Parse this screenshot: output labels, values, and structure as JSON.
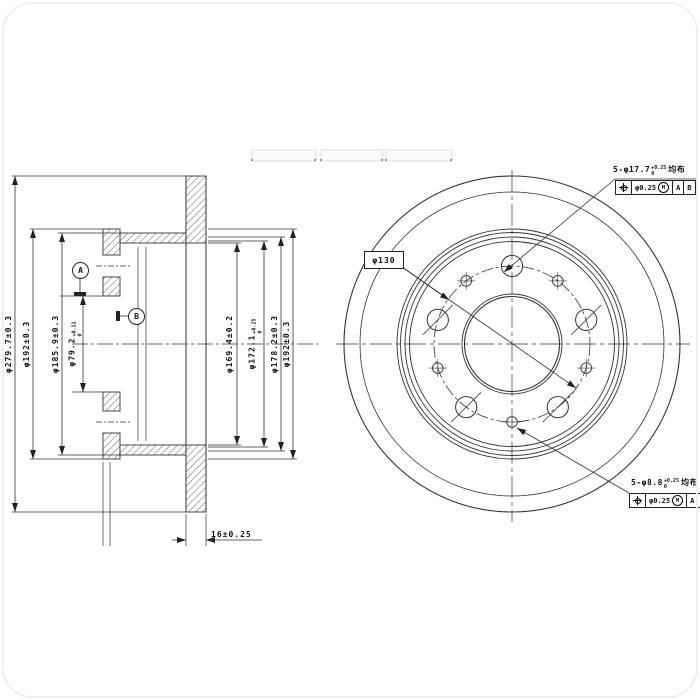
{
  "header_boxes": [
    "",
    "",
    ""
  ],
  "section_view": {
    "left_dimensions": [
      {
        "name": "disc-outer-diameter",
        "label": "φ279.7±0.3"
      },
      {
        "name": "flange-outer-diameter",
        "label": "φ192±0.3"
      },
      {
        "name": "hat-outer-diameter",
        "label": "φ185.9±0.3"
      },
      {
        "name": "center-bore",
        "label": "φ79.2",
        "tol_sup": "+0.11",
        "tol_sub": "0"
      }
    ],
    "right_dimensions": [
      {
        "name": "hat-inner-diameter",
        "label": "φ169.4±0.2"
      },
      {
        "name": "pilot-diameter",
        "label": "φ172.1",
        "tol_sup": "+0.25",
        "tol_sub": "0"
      },
      {
        "name": "recess-diameter",
        "label": "φ178.2±0.3"
      },
      {
        "name": "flange-outer-diameter",
        "label": "φ192±0.3"
      }
    ],
    "thickness": {
      "label": "16±0.25"
    },
    "datums": {
      "a": "A",
      "b": "B"
    }
  },
  "front_view": {
    "bolt_circle_label": "φ130",
    "callouts": {
      "top": {
        "dim": "5-φ17.7",
        "tol_sup": "+0.25",
        "tol_sub": "0",
        "note": "均布",
        "fcf": {
          "tol": "φ0.25",
          "mod": "M",
          "d1": "A",
          "d2": "B"
        }
      },
      "bottom": {
        "dim": "5-φ8.8",
        "tol_sup": "+0.25",
        "tol_sub": "0",
        "note": "均布",
        "fcf": {
          "tol": "φ0.25",
          "mod": "M",
          "d1": "A",
          "d2": "B"
        }
      }
    }
  },
  "colors": {
    "line": "#333333",
    "hatch": "#555555",
    "background": "#ffffff"
  }
}
